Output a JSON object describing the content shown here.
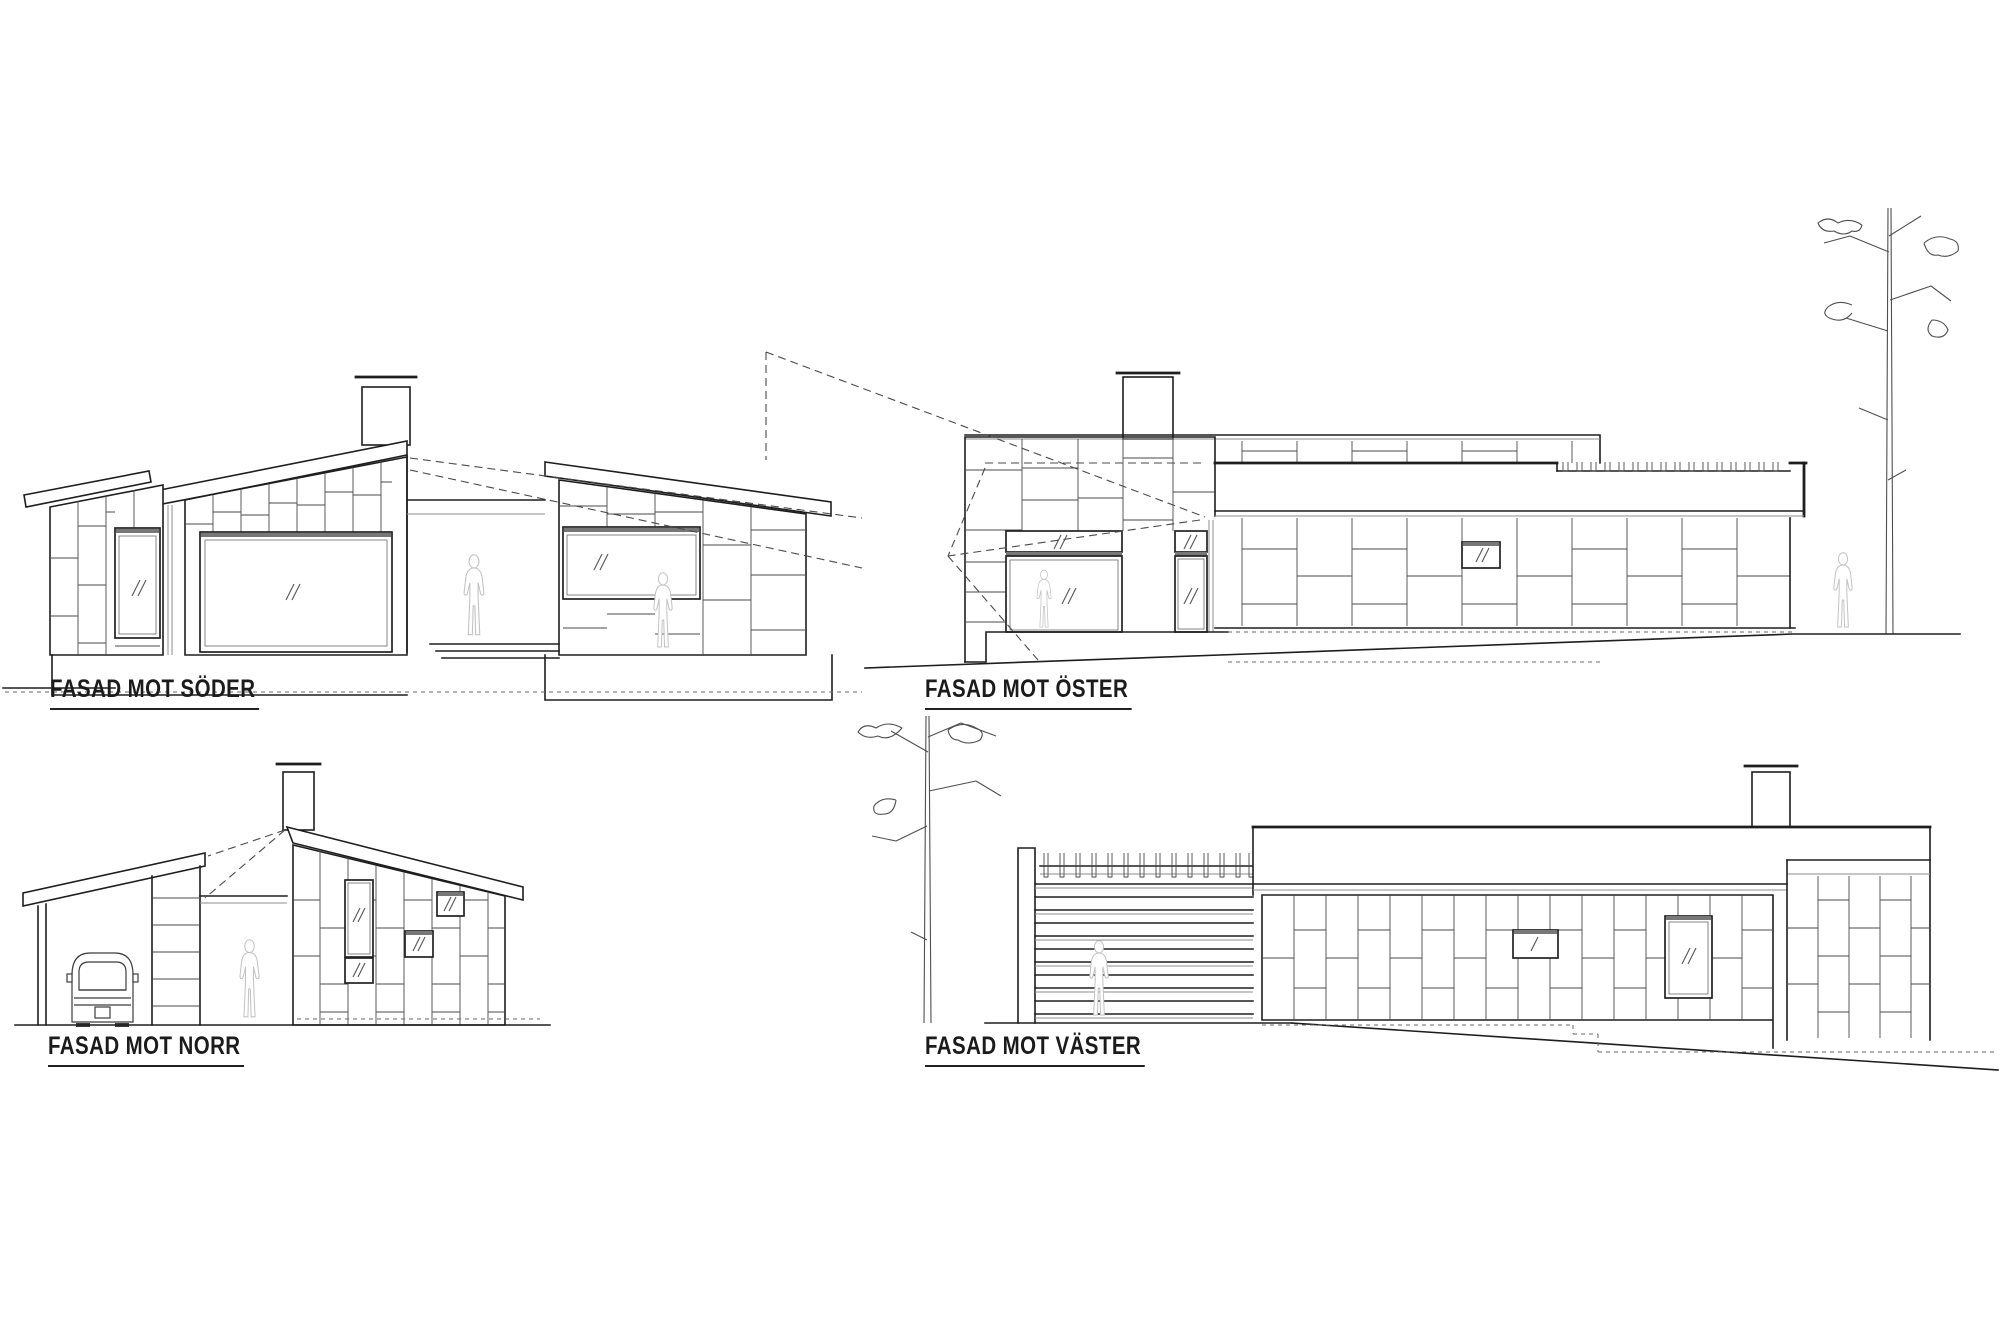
{
  "sheet": {
    "type": "architectural elevation drawing",
    "background": "#ffffff",
    "ink": "#1e1e1e",
    "light_ink": "#c3c3c3",
    "dash_ink": "#4a4a4a"
  },
  "elevations": [
    {
      "id": "south",
      "label": "FASAD MOT SÖDER",
      "features": [
        "sloped shed roofs",
        "chimney",
        "large picture window",
        "two panel windows",
        "recessed entrance porch",
        "human figure silhouettes",
        "foundation plinth",
        "dashed sight lines",
        "dashed ground line"
      ]
    },
    {
      "id": "east",
      "label": "FASAD MOT ÖSTER",
      "features": [
        "flat roof fascia",
        "roof joist row",
        "chimney",
        "glass entrance door",
        "transom windows",
        "small facade window",
        "human figure silhouettes",
        "pine tree",
        "sloping ground line",
        "dashed projection lines"
      ]
    },
    {
      "id": "north",
      "label": "FASAD MOT NORR",
      "features": [
        "carport with car",
        "sloped shed roof",
        "chimney",
        "four panel windows",
        "open passage with human figure",
        "dashed projection lines",
        "ground line"
      ]
    },
    {
      "id": "west",
      "label": "FASAD MOT VÄSTER",
      "features": [
        "pine tree",
        "slatted garage wall with joists",
        "human figure silhouette",
        "flat roof fascia",
        "chimney",
        "two windows",
        "stepped dashed foundation line",
        "sloping ground line"
      ]
    }
  ]
}
